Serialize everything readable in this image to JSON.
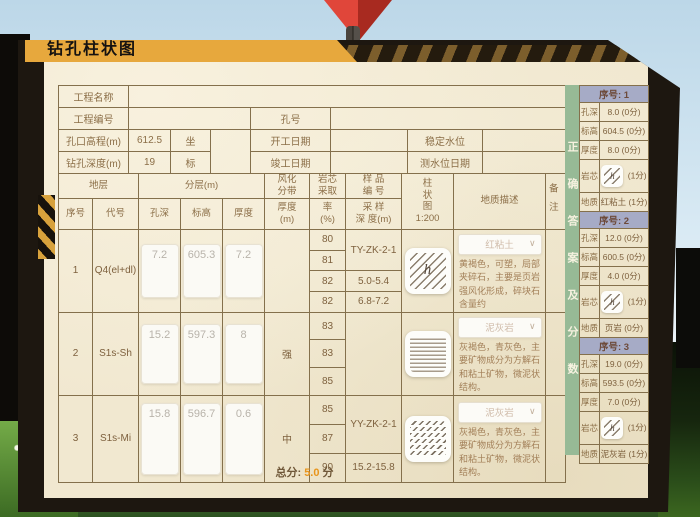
{
  "window": {
    "title": "钻孔柱状图"
  },
  "glyphs": {
    "close": "✕",
    "chevron": "∨",
    "h": "h"
  },
  "colors": {
    "accent_yellow": "#e7a83d",
    "score_orange": "#e8951c",
    "strip_green": "#97ba96",
    "header_lavender": "#a6abc6",
    "marker_red": "#d3392e"
  },
  "info": {
    "project_name": "工程名称",
    "project_no": "工程编号",
    "hole_no": "孔号",
    "elevation_label": "孔口高程(m)",
    "elevation_value": "612.5",
    "coord_top": "坐",
    "coord_bottom": "标",
    "depth_label": "钻孔深度(m)",
    "depth_value": "19",
    "start_date": "开工日期",
    "end_date": "竣工日期",
    "stable_level": "稳定水位",
    "level_date": "测水位日期"
  },
  "grid": {
    "headers": {
      "strata": "地层",
      "layering": "分层(m)",
      "seq": "序号",
      "code": "代号",
      "hole_depth": "孔深",
      "elevation": "标高",
      "thickness": "厚度",
      "weather_a": "风化",
      "weather_b": "分带",
      "weather_c": "厚度",
      "weather_d": "(m)",
      "core_a": "岩芯",
      "core_b": "采取",
      "core_c": "率",
      "core_d": "(%)",
      "sample_a": "样 品",
      "sample_b": "编 号",
      "sample_c": "采 样",
      "sample_d": "深 度(m)",
      "col_a": "柱",
      "col_b": "状",
      "col_c": "图",
      "col_scale": "1:200",
      "geo": "地质描述",
      "note": "备注"
    },
    "rows": [
      {
        "seq": "1",
        "code": "Q4(el+dl)",
        "hole_depth": "7.2",
        "elevation": "605.3",
        "thickness": "7.2",
        "weathering": "",
        "rates": [
          "80",
          "81",
          "82",
          "82"
        ],
        "sample_no": "TY-ZK-2-1",
        "sample_depths": [
          "5.0-5.4",
          "6.8-7.2"
        ],
        "rock": "红粘土",
        "desc": "黄褐色，可塑，局部夹碎石，主要是页岩强风化形成，碎块石含量约"
      },
      {
        "seq": "2",
        "code": "S1s-Sh",
        "hole_depth": "15.2",
        "elevation": "597.3",
        "thickness": "8",
        "weathering": "强",
        "rates": [
          "83",
          "83",
          "85"
        ],
        "sample_no": "",
        "sample_depths": [],
        "rock": "泥灰岩",
        "desc": "灰褐色，青灰色，主要矿物成分为方解石和粘土矿物，微泥状结构。"
      },
      {
        "seq": "3",
        "code": "S1s-Mi",
        "hole_depth": "15.8",
        "elevation": "596.7",
        "thickness": "0.6",
        "weathering": "中",
        "rates": [
          "85",
          "87",
          "90"
        ],
        "sample_no": "YY-ZK-2-1",
        "sample_depths": [
          "15.2-15.8"
        ],
        "rock": "泥灰岩",
        "desc": "灰褐色，青灰色，主要矿物成分为方解石和粘土矿物，微泥状结构。"
      }
    ]
  },
  "answers": {
    "strip": "正确答案及分数",
    "groups": [
      {
        "title": "序号: 1",
        "rows": [
          {
            "label": "孔深",
            "value": "8.0 (0分)"
          },
          {
            "label": "标高",
            "value": "604.5 (0分)"
          },
          {
            "label": "厚度",
            "value": "8.0 (0分)"
          },
          {
            "label": "岩芯",
            "value": "(1分)"
          },
          {
            "label": "地质",
            "value": "红粘土 (1分)"
          }
        ]
      },
      {
        "title": "序号: 2",
        "rows": [
          {
            "label": "孔深",
            "value": "12.0 (0分)"
          },
          {
            "label": "标高",
            "value": "600.5 (0分)"
          },
          {
            "label": "厚度",
            "value": "4.0 (0分)"
          },
          {
            "label": "岩芯",
            "value": "(1分)"
          },
          {
            "label": "地质",
            "value": "页岩 (0分)"
          }
        ]
      },
      {
        "title": "序号: 3",
        "rows": [
          {
            "label": "孔深",
            "value": "19.0 (0分)"
          },
          {
            "label": "标高",
            "value": "593.5 (0分)"
          },
          {
            "label": "厚度",
            "value": "7.0 (0分)"
          },
          {
            "label": "岩芯",
            "value": "(1分)"
          },
          {
            "label": "地质",
            "value": "泥灰岩 (1分)"
          }
        ]
      }
    ]
  },
  "footer": {
    "label": "总分:",
    "value": "5.0",
    "suffix": "分"
  }
}
